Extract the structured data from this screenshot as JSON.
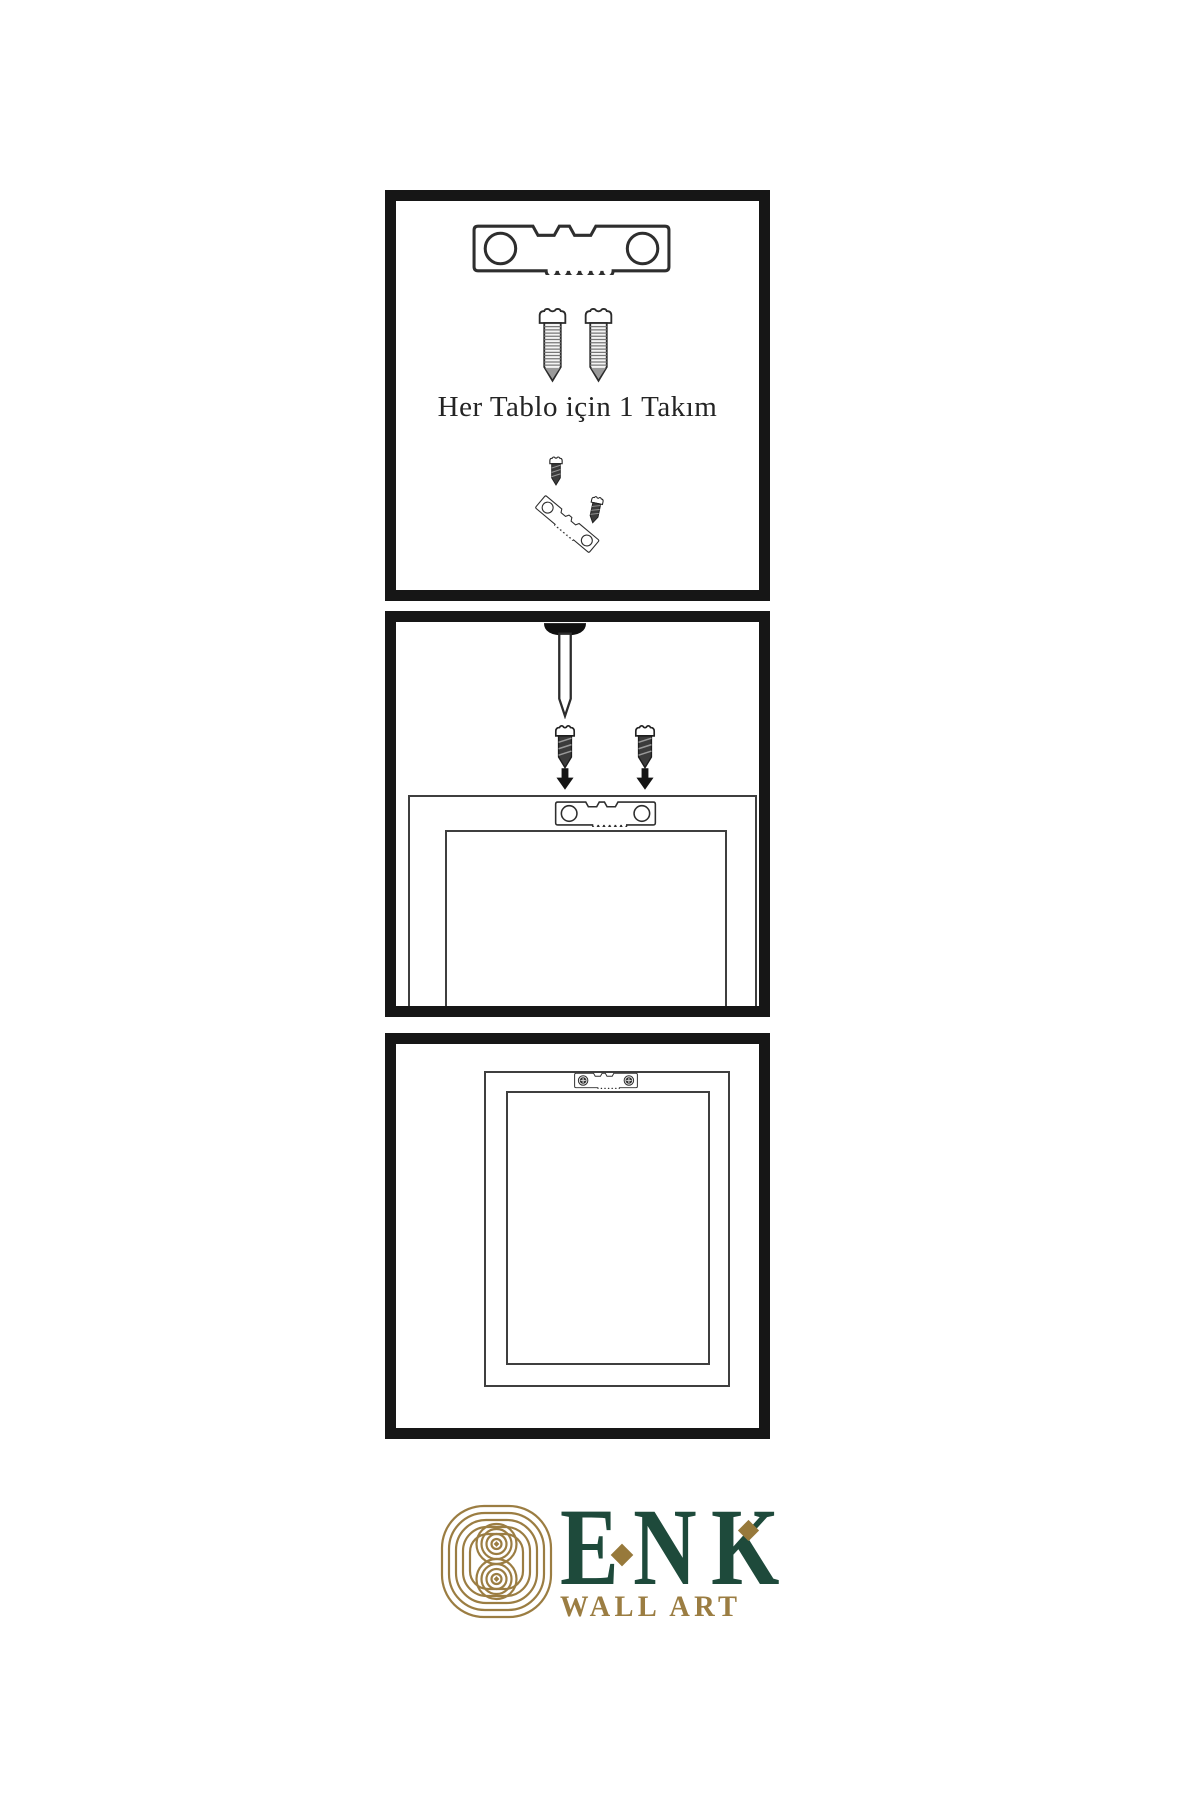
{
  "meta": {
    "description": "Wall art hanging instruction infographic",
    "language": "tr"
  },
  "colors": {
    "background": "#ffffff",
    "panel_border": "#161616",
    "illustration_line": "#2e2e2e",
    "brand_green": "#1e4a3b",
    "brand_gold": "#9b7d42"
  },
  "steps": [
    {
      "id": 1,
      "caption": "Her Tablo için 1 Takım",
      "shows": [
        "sawtooth-hanger",
        "two-screws",
        "screw-into-hanger-mini-diagram"
      ]
    },
    {
      "id": 2,
      "caption": "",
      "shows": [
        "wall-nail",
        "two-screws-with-down-arrows",
        "frame-back-with-sawtooth-hanger"
      ]
    },
    {
      "id": 3,
      "caption": "",
      "shows": [
        "hung-frame-with-mounted-hanger"
      ]
    }
  ],
  "logo": {
    "brand": "ENK",
    "tagline": "WALL ART",
    "mark": "interlaced-knot"
  },
  "icons": {
    "sawtooth_hanger": "metal plate, two round holes, sawtooth bottom edge",
    "screw_light": "outlined screw with horizontal threads",
    "screw_dark": "dark screw with diagonal hatch",
    "nail": "wall nail under top border",
    "arrow_down": "solid black down arrow",
    "knot": "gold interlaced knot monogram"
  }
}
